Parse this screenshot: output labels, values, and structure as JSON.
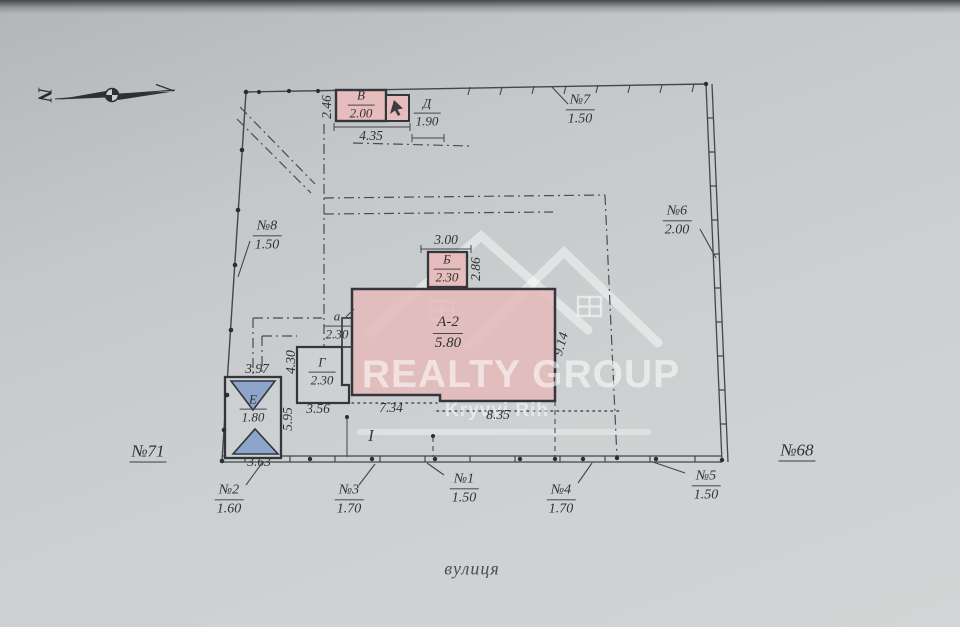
{
  "site": {
    "street": "вулиця",
    "plot_left": "№71",
    "plot_right": "№68",
    "section": "I",
    "north_letter": "N"
  },
  "buildings": {
    "a2": {
      "label": "А-2",
      "value": "5.80"
    },
    "b": {
      "label": "Б",
      "value": "2.30"
    },
    "v": {
      "label": "В",
      "value": "2.00"
    },
    "g": {
      "label": "Г",
      "value": "2.30"
    },
    "d": {
      "label": "Д",
      "value": "1.90"
    },
    "e": {
      "label": "Е",
      "value": "1.80"
    },
    "a": {
      "label": "а",
      "value": "2.30"
    }
  },
  "marks": {
    "n1": {
      "no": "№1",
      "len": "1.50"
    },
    "n2": {
      "no": "№2",
      "len": "1.60"
    },
    "n3": {
      "no": "№3",
      "len": "1.70"
    },
    "n4": {
      "no": "№4",
      "len": "1.70"
    },
    "n5": {
      "no": "№5",
      "len": "1.50"
    },
    "n6": {
      "no": "№6",
      "len": "2.00"
    },
    "n7": {
      "no": "№7",
      "len": "1.50"
    },
    "n8": {
      "no": "№8",
      "len": "1.50"
    }
  },
  "dims": {
    "d435": "4.35",
    "d246": "2.46",
    "d300": "3.00",
    "d286": "2.86",
    "d734": "7.34",
    "d835": "8.35",
    "d914": "9.14",
    "d430": "4.30",
    "d397": "3.97",
    "d595": "5.95",
    "d356": "3.56",
    "d363": "3.63"
  },
  "watermark": {
    "name": "REALTY GROUP",
    "city": "Kryvyi Rih"
  },
  "colors": {
    "building_fill": "#e7bcbc",
    "roof_fill": "#8da5cb",
    "line": "#3f4246"
  }
}
